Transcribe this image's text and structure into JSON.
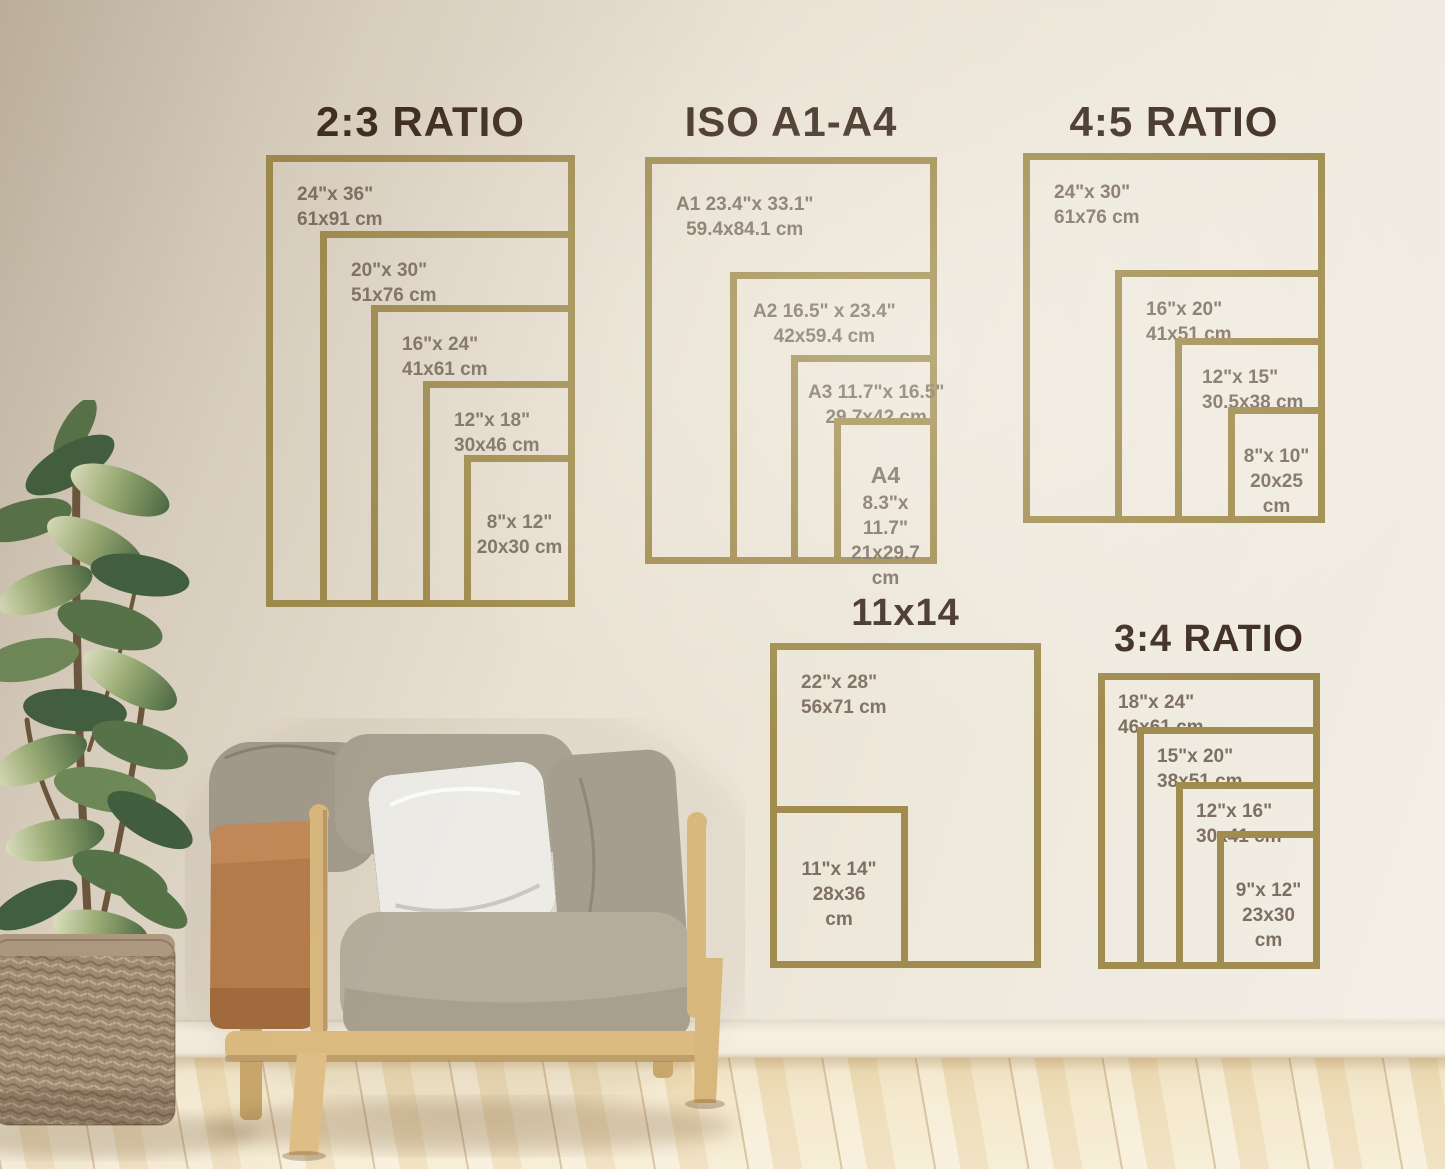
{
  "theme": {
    "frame-gold": "#a08c4e",
    "title-brown": "#3e2c20",
    "label-brown": "#7d7062",
    "wall-light": "#f3efe7",
    "wall-dark": "#cdc2b0",
    "baseboard-cream": "#f5efe1",
    "floor-wood": "#f3e6c6",
    "leaf-green": "#4c6a44",
    "wood-light": "#d9b87e",
    "leather-tan": "#b57c4b"
  },
  "sections": [
    {
      "title": "2:3 RATIO",
      "frames": [
        {
          "name": "24x36",
          "lines": [
            "24\"x 36\"",
            "61x91 cm"
          ]
        },
        {
          "name": "20x30",
          "lines": [
            "20\"x 30\"",
            "51x76 cm"
          ]
        },
        {
          "name": "16x24",
          "lines": [
            "16\"x 24\"",
            "41x61 cm"
          ]
        },
        {
          "name": "12x18",
          "lines": [
            "12\"x 18\"",
            "30x46 cm"
          ]
        },
        {
          "name": "8x12",
          "lines": [
            "8\"x 12\"",
            "20x30 cm"
          ]
        }
      ]
    },
    {
      "title": "ISO A1-A4",
      "frames": [
        {
          "name": "A1",
          "lines": [
            "A1 23.4\"x 33.1\"",
            "59.4x84.1 cm"
          ]
        },
        {
          "name": "A2",
          "lines": [
            "A2 16.5\" x 23.4\"",
            "42x59.4 cm"
          ]
        },
        {
          "name": "A3",
          "lines": [
            "A3 11.7\"x 16.5\"",
            "29.7x42 cm"
          ]
        },
        {
          "name": "A4",
          "lines": [
            "A4",
            "8.3\"x 11.7\"",
            "21x29.7",
            "cm"
          ]
        }
      ]
    },
    {
      "title": "4:5 RATIO",
      "frames": [
        {
          "name": "24x30",
          "lines": [
            "24\"x 30\"",
            "61x76 cm"
          ]
        },
        {
          "name": "16x20",
          "lines": [
            "16\"x 20\"",
            "41x51 cm"
          ]
        },
        {
          "name": "12x15",
          "lines": [
            "12\"x 15\"",
            "30.5x38 cm"
          ]
        },
        {
          "name": "8x10",
          "lines": [
            "8\"x 10\"",
            "20x25",
            "cm"
          ]
        }
      ]
    },
    {
      "title": "11x14",
      "frames": [
        {
          "name": "22x28",
          "lines": [
            "22\"x 28\"",
            "56x71 cm"
          ]
        },
        {
          "name": "11x14",
          "lines": [
            "11\"x 14\"",
            "28x36",
            "cm"
          ]
        }
      ]
    },
    {
      "title": "3:4 RATIO",
      "frames": [
        {
          "name": "18x24",
          "lines": [
            "18\"x 24\"",
            "46x61 cm"
          ]
        },
        {
          "name": "15x20",
          "lines": [
            "15\"x 20\"",
            "38x51 cm"
          ]
        },
        {
          "name": "12x16",
          "lines": [
            "12\"x 16\"",
            "30x41 cm"
          ]
        },
        {
          "name": "9x12",
          "lines": [
            "9\"x 12\"",
            "23x30",
            "cm"
          ]
        }
      ]
    }
  ]
}
